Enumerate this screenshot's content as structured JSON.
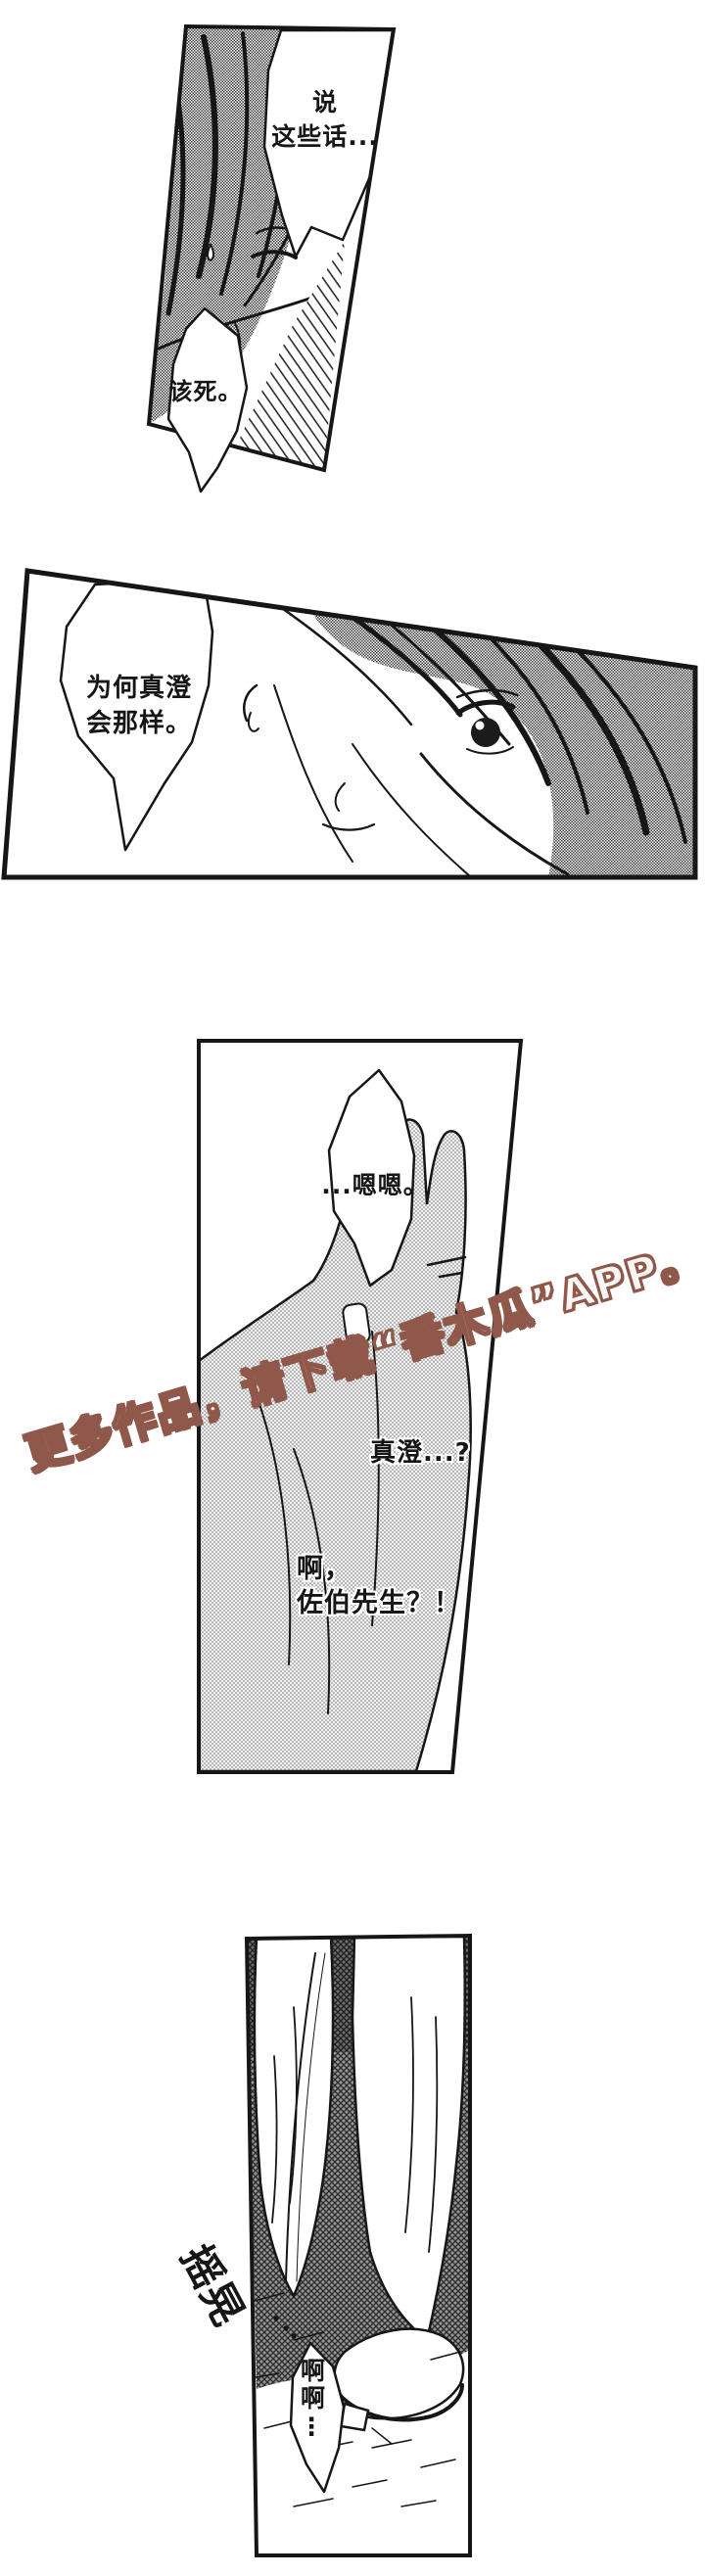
{
  "colors": {
    "paper": "#ffffff",
    "ink": "#161616",
    "tone": "#8d8d8d",
    "watermark": "#8f584b"
  },
  "watermark": {
    "text": "更多作品，请下载“番木瓜”APP。"
  },
  "panels": {
    "p1": {
      "bubble_shout": "说\n这些话...",
      "bubble_curse": "该死。"
    },
    "p2": {
      "bubble_thought": "为何真澄\n会那样。"
    },
    "p3": {
      "bubble_reply": "...嗯嗯。",
      "caption_name": "真澄...?",
      "caption_surprise": "啊，\n佐伯先生？！"
    },
    "p4": {
      "sfx": "摇晃",
      "bubble_gasp": "啊啊⋮"
    }
  }
}
